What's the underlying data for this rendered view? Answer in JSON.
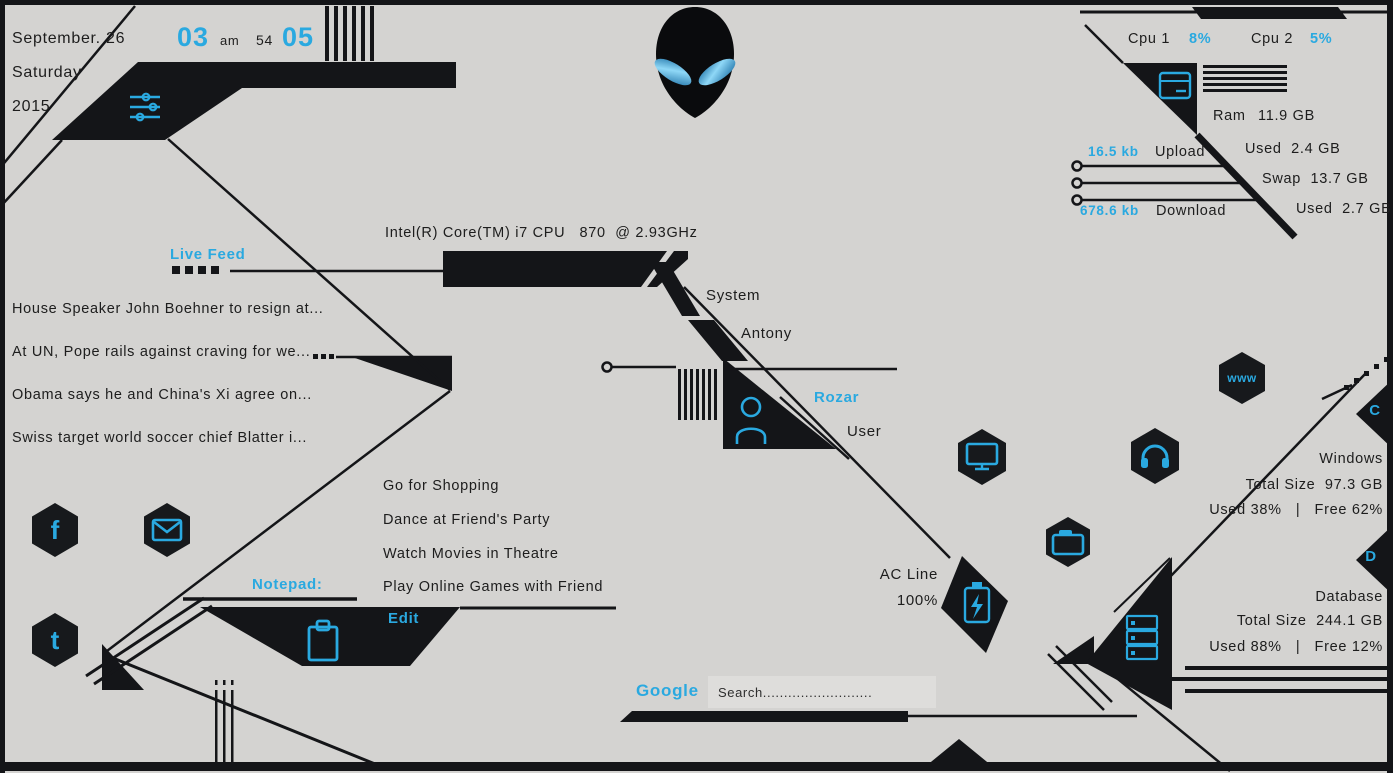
{
  "accent": "#2aa9e0",
  "background": "#d4d3d1",
  "date": {
    "full": "September. 26",
    "weekday": "Saturday",
    "year": "2015"
  },
  "clock": {
    "hour": "03",
    "meridiem": "am",
    "minute": "54",
    "second": "05"
  },
  "cpu": {
    "cpu1_label": "Cpu 1",
    "cpu1_value": "8%",
    "cpu2_label": "Cpu 2",
    "cpu2_value": "5%",
    "chip_name": "Intel(R) Core(TM) i7 CPU   870  @ 2.93GHz"
  },
  "memory": {
    "ram_label": "Ram",
    "ram_total": "11.9 GB",
    "ram_used": "Used  2.4 GB",
    "swap_total": "Swap  13.7 GB",
    "swap_used": "Used  2.7 GB"
  },
  "network": {
    "upload_value": "16.5 kb",
    "upload_label": "Upload",
    "download_value": "678.6 kb",
    "download_label": "Download"
  },
  "live_feed": {
    "title": "Live Feed",
    "items": [
      "House Speaker John Boehner to resign at...",
      "At UN, Pope rails against craving for we...",
      "Obama says he and China's Xi agree on...",
      "Swiss target world soccer chief Blatter i..."
    ]
  },
  "identity": {
    "system_label": "System",
    "system_name": "Antony",
    "user_name": "Rozar",
    "user_label": "User"
  },
  "todo": {
    "items": [
      "Go for Shopping",
      "Dance at Friend's Party",
      "Watch Movies in Theatre",
      "Play Online Games with Friend"
    ]
  },
  "notepad": {
    "title": "Notepad:",
    "edit_label": "Edit"
  },
  "power": {
    "label": "AC Line",
    "value": "100%"
  },
  "drives": {
    "c_badge": "C",
    "d_badge": "D",
    "windows": {
      "name": "Windows",
      "total": "Total Size  97.3 GB",
      "usage": "Used 38%   |   Free 62%"
    },
    "database": {
      "name": "Database",
      "total": "Total Size  244.1 GB",
      "usage": "Used 88%   |   Free 12%"
    }
  },
  "search": {
    "engine": "Google",
    "placeholder": "Search.........................."
  },
  "badges": {
    "web": "www",
    "facebook": "f",
    "tumblr": "t"
  },
  "icons": {
    "brand": "alien-icon",
    "settings": "sliders-icon",
    "ram": "memory-icon",
    "user": "person-icon",
    "notepad": "clipboard-icon",
    "power": "battery-icon",
    "display": "monitor-icon",
    "audio": "headphones-icon",
    "files": "folder-icon",
    "storage": "server-icon",
    "mail": "envelope-icon"
  }
}
